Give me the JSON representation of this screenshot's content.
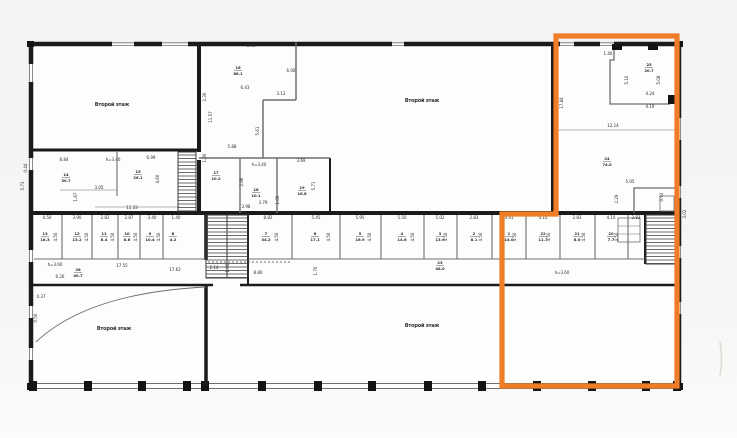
{
  "page": {
    "background_top": "#f3f3f1",
    "background_bottom": "#fbfbfa",
    "paper": "#fdfdfc"
  },
  "colors": {
    "wall": "#1b1b1b",
    "thin_line": "#6e6e6e",
    "text": "#2a2a2a",
    "highlight": "#ee7c28"
  },
  "plan": {
    "name": "scanned-floor-plan",
    "floor_labels": [
      {
        "text": "Второй этаж",
        "x": 112,
        "y": 106
      },
      {
        "text": "Второй этаж",
        "x": 422,
        "y": 102
      },
      {
        "text": "Второй этаж",
        "x": 114,
        "y": 330
      },
      {
        "text": "Второй этаж",
        "x": 422,
        "y": 327
      }
    ],
    "dimensions": [
      {
        "t": "0.44",
        "x": 27,
        "y": 168,
        "r": -90
      },
      {
        "t": "5.73",
        "x": 24,
        "y": 186,
        "r": -90
      },
      {
        "t": "8.84",
        "x": 64,
        "y": 161
      },
      {
        "t": "h=3.40",
        "x": 113,
        "y": 161
      },
      {
        "t": "6.99",
        "x": 151,
        "y": 159
      },
      {
        "t": "4.60",
        "x": 159,
        "y": 179,
        "r": -90
      },
      {
        "t": "3.05",
        "x": 99,
        "y": 189
      },
      {
        "t": "1.67",
        "x": 77,
        "y": 197,
        "r": -90
      },
      {
        "t": "11.33",
        "x": 132,
        "y": 209
      },
      {
        "t": "6.40",
        "x": 251,
        "y": 47
      },
      {
        "t": "6.43",
        "x": 245,
        "y": 89
      },
      {
        "t": "6.00",
        "x": 291,
        "y": 72
      },
      {
        "t": "3.13",
        "x": 281,
        "y": 95
      },
      {
        "t": "2.30",
        "x": 206,
        "y": 97,
        "r": -90
      },
      {
        "t": "11.57",
        "x": 212,
        "y": 117,
        "r": -90
      },
      {
        "t": "5.61",
        "x": 259,
        "y": 131,
        "r": -90
      },
      {
        "t": "5.88",
        "x": 232,
        "y": 148
      },
      {
        "t": "1.30",
        "x": 206,
        "y": 158,
        "r": -90
      },
      {
        "t": "h=3.40",
        "x": 259,
        "y": 166
      },
      {
        "t": "3.69",
        "x": 301,
        "y": 162
      },
      {
        "t": "2.86",
        "x": 243,
        "y": 182,
        "r": -90
      },
      {
        "t": "5.71",
        "x": 315,
        "y": 186,
        "r": -90
      },
      {
        "t": "1.00",
        "x": 279,
        "y": 200,
        "r": -90
      },
      {
        "t": "3.79",
        "x": 263,
        "y": 204
      },
      {
        "t": "3.98",
        "x": 246,
        "y": 208
      },
      {
        "t": "1.40",
        "x": 608,
        "y": 55
      },
      {
        "t": "5.10",
        "x": 628,
        "y": 80,
        "r": -90
      },
      {
        "t": "5.08",
        "x": 660,
        "y": 80,
        "r": -90
      },
      {
        "t": "4.24",
        "x": 650,
        "y": 95
      },
      {
        "t": "4.19",
        "x": 650,
        "y": 108
      },
      {
        "t": "17.84",
        "x": 563,
        "y": 103,
        "r": -90
      },
      {
        "t": "12.14",
        "x": 613,
        "y": 127
      },
      {
        "t": "5.05",
        "x": 630,
        "y": 183
      },
      {
        "t": "2.29",
        "x": 618,
        "y": 199,
        "r": -90
      },
      {
        "t": "0.92",
        "x": 663,
        "y": 197,
        "r": -90
      },
      {
        "t": "3.02",
        "x": 686,
        "y": 214,
        "r": -90
      },
      {
        "t": "4.50",
        "x": 47,
        "y": 219
      },
      {
        "t": "3.90",
        "x": 77,
        "y": 219
      },
      {
        "t": "2.82",
        "x": 105,
        "y": 219
      },
      {
        "t": "2.87",
        "x": 129,
        "y": 219
      },
      {
        "t": "3.40",
        "x": 152,
        "y": 219
      },
      {
        "t": "1.40",
        "x": 176,
        "y": 219
      },
      {
        "t": "8.82",
        "x": 268,
        "y": 219
      },
      {
        "t": "5.45",
        "x": 316,
        "y": 219
      },
      {
        "t": "5.95",
        "x": 360,
        "y": 219
      },
      {
        "t": "5.50",
        "x": 402,
        "y": 219
      },
      {
        "t": "5.02",
        "x": 440,
        "y": 219
      },
      {
        "t": "2.83",
        "x": 474,
        "y": 219
      },
      {
        "t": "4.91",
        "x": 509,
        "y": 219
      },
      {
        "t": "4.10",
        "x": 543,
        "y": 219
      },
      {
        "t": "2.83",
        "x": 577,
        "y": 219
      },
      {
        "t": "4.10",
        "x": 611,
        "y": 219
      },
      {
        "t": "2.83",
        "x": 636,
        "y": 219
      },
      {
        "t": "4.50",
        "x": 57,
        "y": 237,
        "r": -90
      },
      {
        "t": "4.50",
        "x": 88,
        "y": 237,
        "r": -90
      },
      {
        "t": "4.50",
        "x": 114,
        "y": 237,
        "r": -90
      },
      {
        "t": "4.50",
        "x": 137,
        "y": 237,
        "r": -90
      },
      {
        "t": "4.50",
        "x": 160,
        "y": 237,
        "r": -90
      },
      {
        "t": "4.50",
        "x": 278,
        "y": 237,
        "r": -90
      },
      {
        "t": "4.50",
        "x": 330,
        "y": 237,
        "r": -90
      },
      {
        "t": "4.50",
        "x": 371,
        "y": 237,
        "r": -90
      },
      {
        "t": "4.50",
        "x": 414,
        "y": 237,
        "r": -90
      },
      {
        "t": "4.50",
        "x": 447,
        "y": 237,
        "r": -90
      },
      {
        "t": "4.50",
        "x": 482,
        "y": 237,
        "r": -90
      },
      {
        "t": "4.50",
        "x": 516,
        "y": 237,
        "r": -90
      },
      {
        "t": "4.50",
        "x": 550,
        "y": 237,
        "r": -90
      },
      {
        "t": "4.50",
        "x": 585,
        "y": 237,
        "r": -90
      },
      {
        "t": "4.50",
        "x": 618,
        "y": 237,
        "r": -90
      },
      {
        "t": "h=3.60",
        "x": 55,
        "y": 266
      },
      {
        "t": "6.26",
        "x": 60,
        "y": 278
      },
      {
        "t": "17.55",
        "x": 122,
        "y": 267
      },
      {
        "t": "17.62",
        "x": 175,
        "y": 271
      },
      {
        "t": "2.14",
        "x": 214,
        "y": 269
      },
      {
        "t": "1.15",
        "x": 229,
        "y": 268,
        "r": -90
      },
      {
        "t": "8.80",
        "x": 258,
        "y": 274
      },
      {
        "t": "1.70",
        "x": 317,
        "y": 271,
        "r": -90
      },
      {
        "t": "h=3.60",
        "x": 562,
        "y": 274
      },
      {
        "t": "0.37",
        "x": 41,
        "y": 298
      },
      {
        "t": "0.50",
        "x": 37,
        "y": 318,
        "r": -90
      }
    ],
    "room_tags": [
      {
        "n": "14",
        "a": "30.7",
        "x": 66,
        "y": 176
      },
      {
        "n": "15",
        "a": "26.1",
        "x": 138,
        "y": 173
      },
      {
        "n": "16",
        "a": "68.1",
        "x": 238,
        "y": 69
      },
      {
        "n": "17",
        "a": "10.2",
        "x": 216,
        "y": 174
      },
      {
        "n": "18",
        "a": "10.1",
        "x": 256,
        "y": 191
      },
      {
        "n": "19",
        "a": "16.8",
        "x": 302,
        "y": 189
      },
      {
        "n": "25",
        "a": "20.7",
        "x": 649,
        "y": 66
      },
      {
        "n": "24",
        "a": "74.0",
        "x": 607,
        "y": 160
      },
      {
        "n": "13",
        "a": "18.3",
        "x": 45,
        "y": 235
      },
      {
        "n": "12",
        "a": "13.2",
        "x": 77,
        "y": 235
      },
      {
        "n": "11",
        "a": "8.4",
        "x": 104,
        "y": 235
      },
      {
        "n": "10",
        "a": "8.6",
        "x": 127,
        "y": 235
      },
      {
        "n": "9",
        "a": "10.4",
        "x": 150,
        "y": 235
      },
      {
        "n": "8",
        "a": "4.2",
        "x": 173,
        "y": 235
      },
      {
        "n": "7",
        "a": "34.2",
        "x": 266,
        "y": 235
      },
      {
        "n": "6",
        "a": "17.1",
        "x": 315,
        "y": 235
      },
      {
        "n": "5",
        "a": "16.9",
        "x": 360,
        "y": 235
      },
      {
        "n": "4",
        "a": "14.6",
        "x": 402,
        "y": 235
      },
      {
        "n": "3",
        "a": "13.9",
        "x": 440,
        "y": 235
      },
      {
        "n": "2",
        "a": "8.1",
        "x": 474,
        "y": 235
      },
      {
        "n": "1",
        "a": "14.0",
        "x": 509,
        "y": 235
      },
      {
        "n": "22",
        "a": "11.7",
        "x": 543,
        "y": 235
      },
      {
        "n": "21",
        "a": "8.0",
        "x": 577,
        "y": 235
      },
      {
        "n": "20",
        "a": "7.7",
        "x": 611,
        "y": 235
      },
      {
        "n": "23",
        "a": "48.0",
        "x": 440,
        "y": 264
      },
      {
        "n": "26",
        "a": "40.7",
        "x": 78,
        "y": 271
      }
    ]
  },
  "highlight": {
    "label": "selected-region",
    "points": "556,36 677,36 677,386 502,386 502,214 556,214"
  }
}
